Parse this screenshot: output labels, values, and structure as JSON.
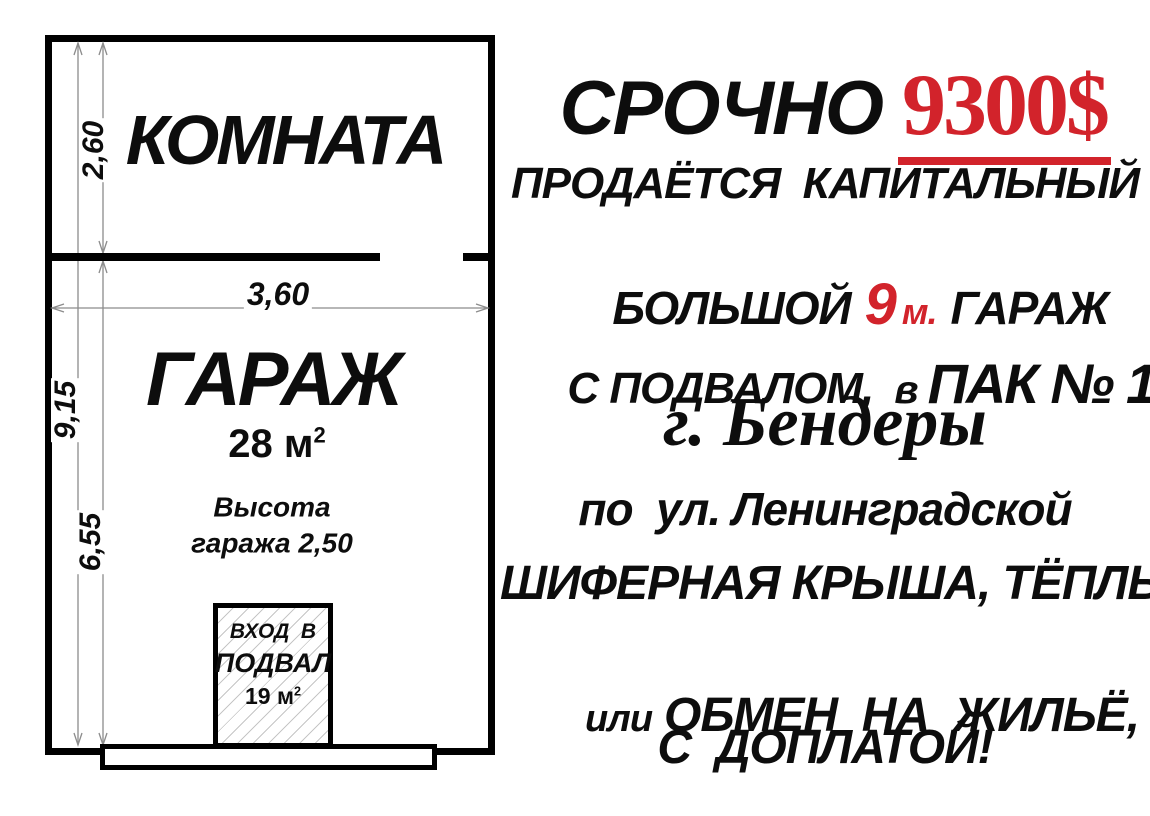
{
  "poster": {
    "plan": {
      "room_label": "КОМНАТА",
      "garage_label": "ГАРАЖ",
      "garage_area_value": "28 м",
      "garage_area_sup": "2",
      "height_note_line1": "Высота",
      "height_note_line2": "гаража 2,50",
      "dims": {
        "room_height": "2,60",
        "total_height": "9,15",
        "garage_height": "6,55",
        "width": "3,60"
      },
      "cellar_entrance": {
        "line1": "ВХОД  В",
        "line2": "ПОДВАЛ",
        "area_value": "19 м",
        "area_sup": "2"
      }
    },
    "ad_text": {
      "urgent": "СРОЧНО",
      "price": "9300$",
      "line_selling": "ПРОДАЁТСЯ  КАПИТАЛЬНЫЙ",
      "line_big": "БОЛЬШОЙ",
      "line_big_number": "9",
      "line_big_unit": "м.",
      "line_big_garage": "ГАРАЖ",
      "line_basement": "С ПОДВАЛОМ, ",
      "line_basement_small": "в",
      "line_basement_pak": "ПАК № 12",
      "city": "г. Бендеры",
      "street": "по  ул. Ленинградской",
      "roof": "ШИФЕРНАЯ КРЫША, ТЁПЛЫЙ",
      "exchange_small": "или",
      "exchange": "ОБМЕН  НА  ЖИЛЬЁ,",
      "surcharge": "С  ДОПЛАТОЙ!"
    },
    "colors": {
      "accent_red": "#d2232b",
      "text_black": "#0d0d0d",
      "dim_line_gray": "#8c8c8c"
    }
  }
}
